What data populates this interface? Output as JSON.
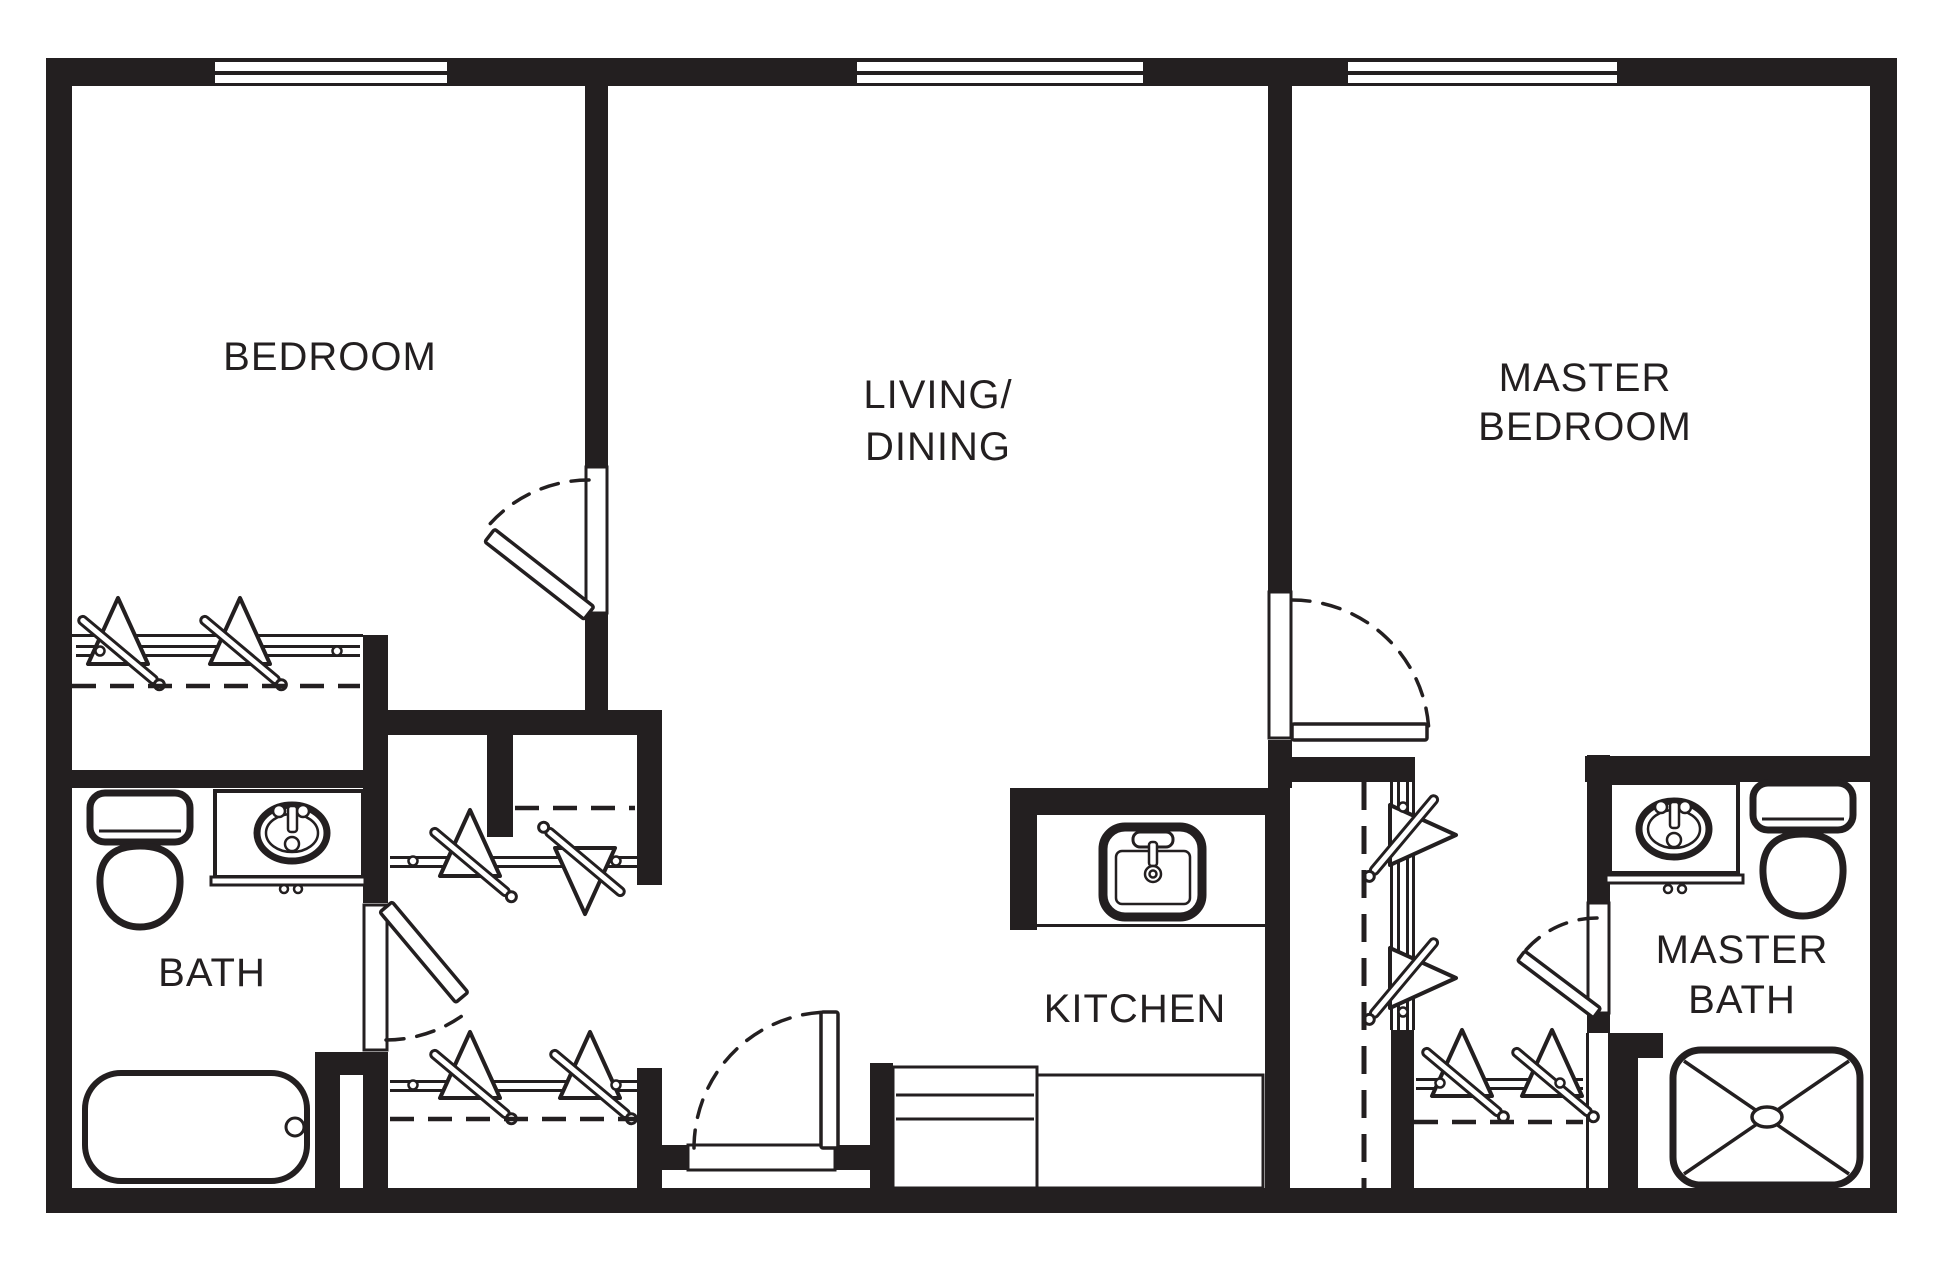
{
  "plan": {
    "type": "apartment-floor-plan",
    "colors": {
      "wall": "#231f20",
      "background": "#ffffff",
      "line": "#231f20"
    },
    "rooms": [
      {
        "name": "bedroom",
        "lines": [
          "BEDROOM"
        ]
      },
      {
        "name": "living-dining",
        "lines": [
          "LIVING/",
          "DINING"
        ]
      },
      {
        "name": "master-bedroom",
        "lines": [
          "MASTER",
          "BEDROOM"
        ]
      },
      {
        "name": "bath",
        "lines": [
          "BATH"
        ]
      },
      {
        "name": "kitchen",
        "lines": [
          "KITCHEN"
        ]
      },
      {
        "name": "master-bath",
        "lines": [
          "MASTER",
          "BATH"
        ]
      }
    ],
    "icons": {
      "window-icon": "double-line wall window symbol (3 on top wall)",
      "door-swing-icon": "door leaf with dashed quarter-circle swing arc (5 doors)",
      "closet-rod-icon": "closet rod with wire hangers and dashed shelf line (5 closets)",
      "toilet-icon": "toilet tank and bowl (2)",
      "vanity-sink-icon": "vanity counter with oval sink and faucet (2)",
      "bathtub-icon": "bathtub with drain",
      "shower-icon": "shower pan with crossed diagonals and drain",
      "kitchen-sink-icon": "kitchen sink with faucet and drain",
      "counter-icon": "kitchen base counters"
    }
  }
}
